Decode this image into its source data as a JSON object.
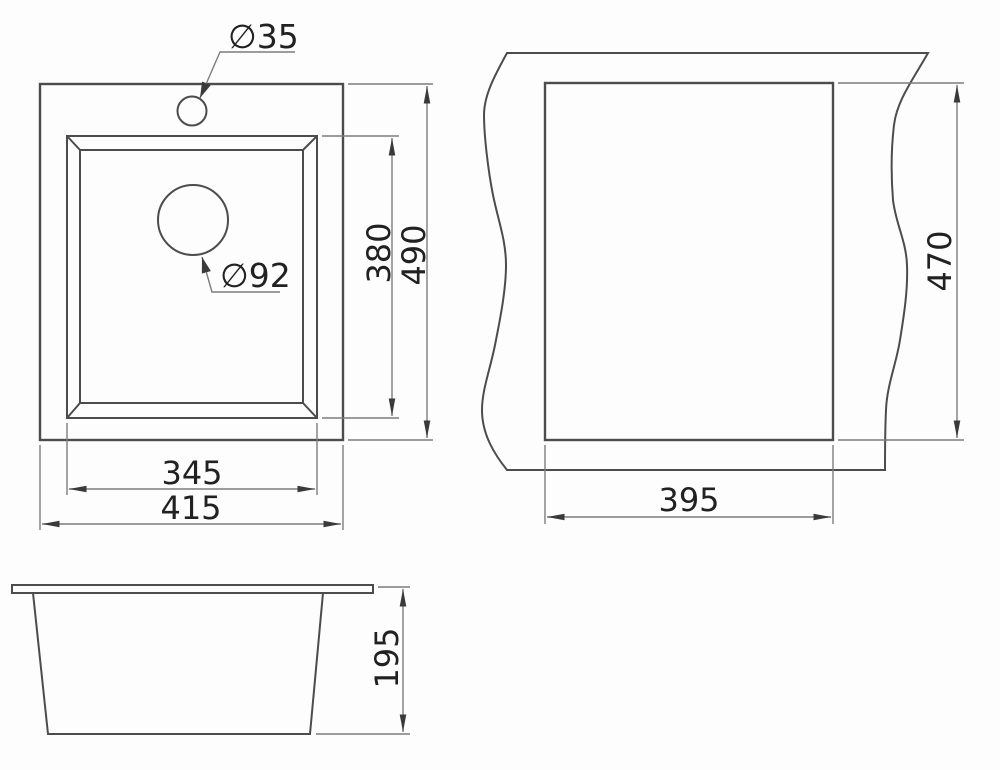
{
  "meta": {
    "title": "Sink installation technical drawing",
    "colors": {
      "bg": "#fdfdfd",
      "obj": "#4c4c4c",
      "dim": "#7d7d7d",
      "txt": "#212121",
      "arrow": "#3a3a3a"
    }
  },
  "top_view": {
    "faucet_hole_diameter": "∅35",
    "drain_hole_diameter": "∅92",
    "bowl_width": "345",
    "overall_width": "415",
    "bowl_length": "380",
    "overall_length": "490"
  },
  "cutout_view": {
    "cutout_width": "395",
    "cutout_length": "470"
  },
  "front_view": {
    "bowl_depth": "195"
  }
}
